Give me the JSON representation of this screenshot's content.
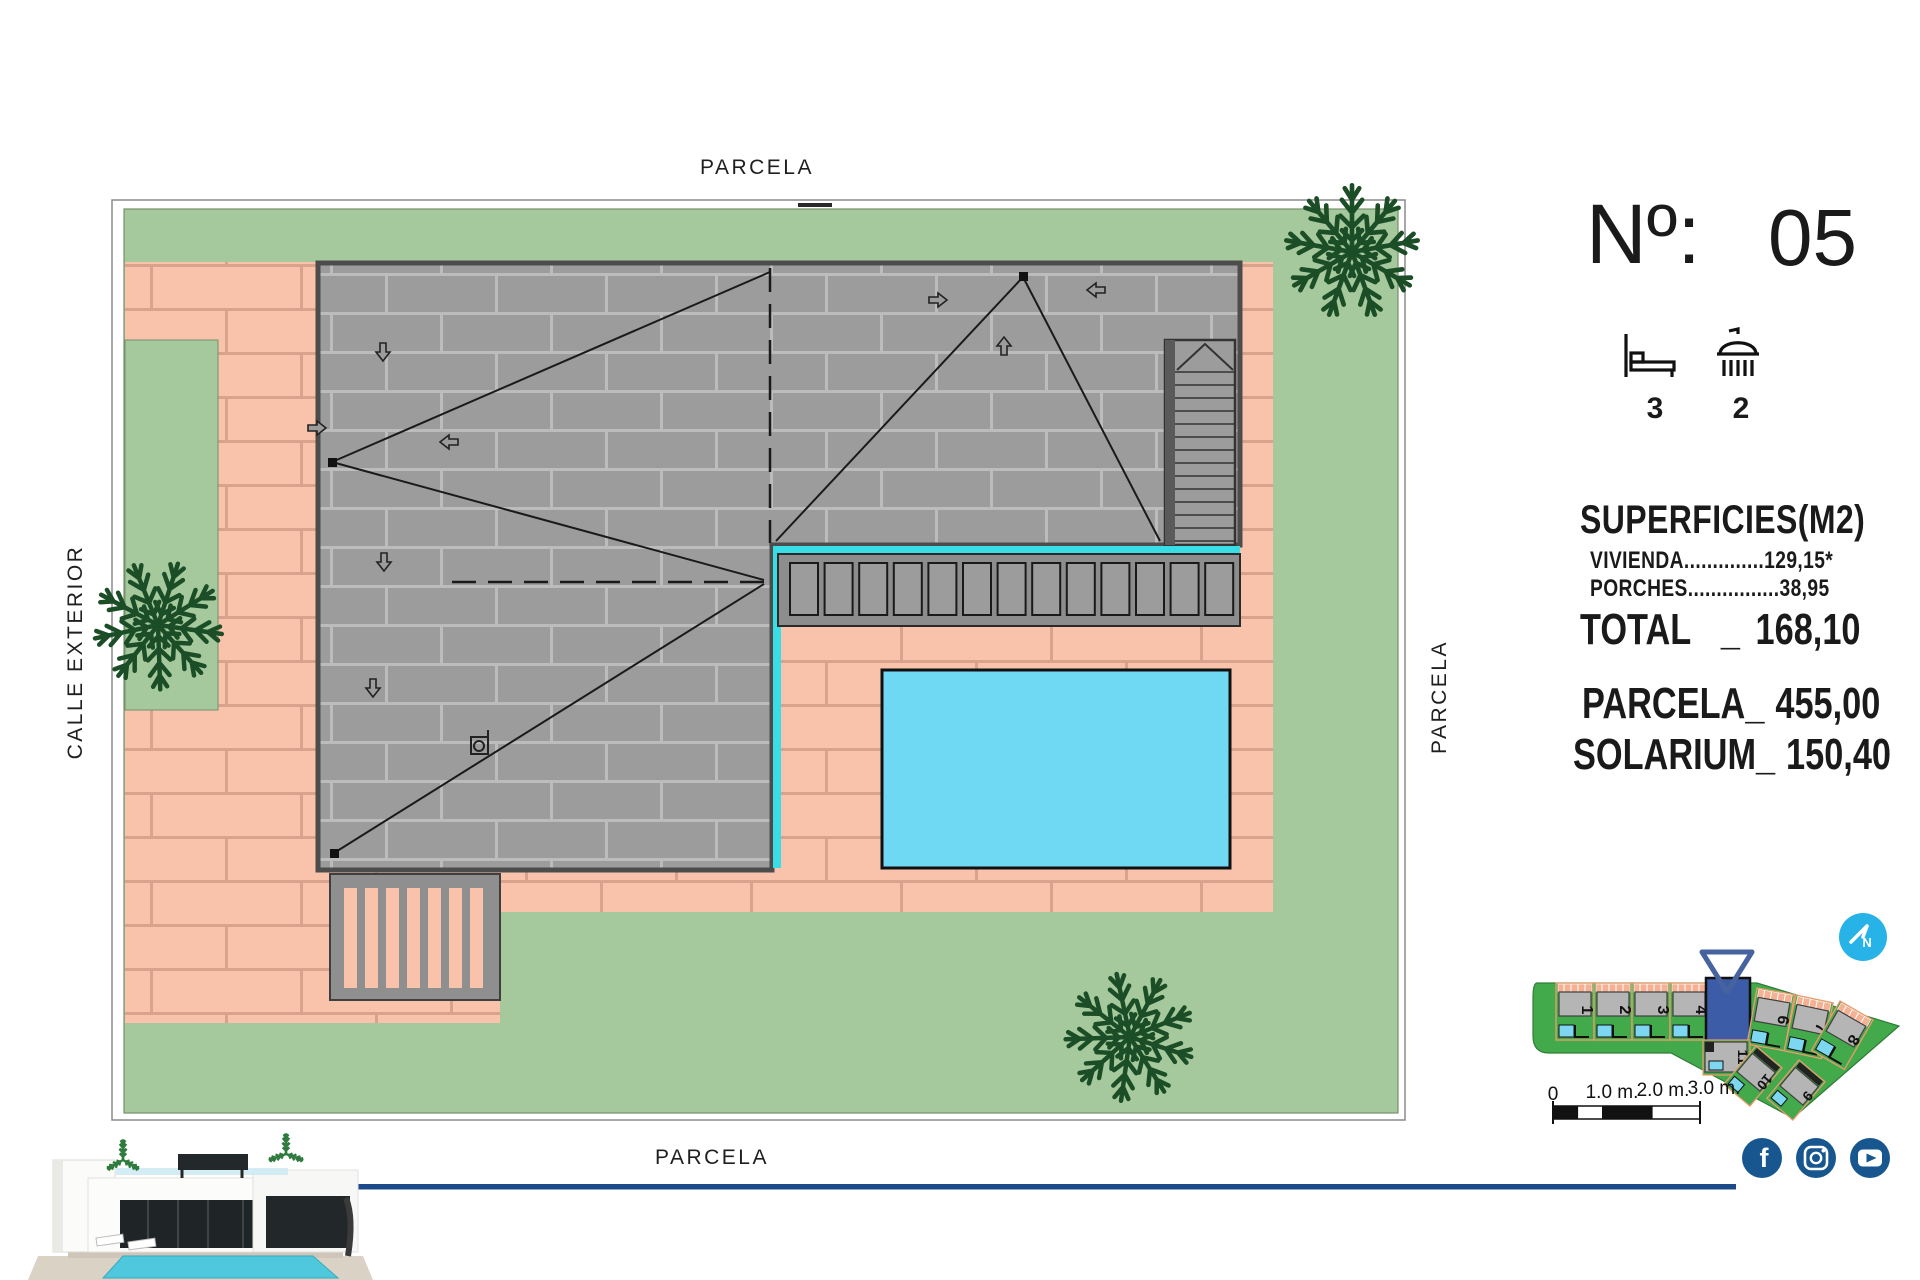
{
  "page": {
    "background": "#ffffff"
  },
  "plan": {
    "label_top": "PARCELA",
    "label_bottom": "PARCELA",
    "label_right": "PARCELA",
    "label_left": "CALLE EXTERIOR"
  },
  "info": {
    "number_label": "Nº:",
    "number_value": "05",
    "bedrooms": "3",
    "bathrooms": "2",
    "surfaces_title": "SUPERFICIES(M2)",
    "rows": [
      {
        "label": "VIVIENDA",
        "leader": "..............",
        "value": "129,15*"
      },
      {
        "label": "PORCHES",
        "leader": "................",
        "value": "38,95"
      }
    ],
    "total": {
      "label": "TOTAL",
      "sep": "_",
      "value": "168,10"
    },
    "parcela": {
      "label": "PARCELA_",
      "value": "455,00"
    },
    "solarium": {
      "label": "SOLARIUM_",
      "value": "150,40"
    }
  },
  "minimap": {
    "highlighted_plot": "5",
    "plots": [
      {
        "label": "1"
      },
      {
        "label": "2"
      },
      {
        "label": "3"
      },
      {
        "label": "4"
      },
      {
        "label": "6"
      },
      {
        "label": "7"
      },
      {
        "label": "8"
      },
      {
        "label": "11"
      },
      {
        "label": "10"
      },
      {
        "label": "9"
      }
    ]
  },
  "scalebar": {
    "labels": [
      "0",
      "1.0 m.",
      "2.0 m.",
      "3.0 m."
    ]
  },
  "social": {
    "facebook_glyph": "f"
  },
  "compass": {
    "letter": "N"
  },
  "colors": {
    "lawn": "#a6c89d",
    "paving": "#f9c3ab",
    "paving_joint": "#d9a28c",
    "roof": "#9c9c9c",
    "roof_joint": "#bcbcbc",
    "pool": "#6fd8f3",
    "cyan_line": "#38dde6",
    "palm": "#1b4e26",
    "minimap_green": "#42aa4b",
    "highlight_blue": "#3c5ca8",
    "social_blue": "#17568f",
    "compass_cyan": "#27b3e8",
    "accent_line_blue": "#1d4b8a"
  }
}
